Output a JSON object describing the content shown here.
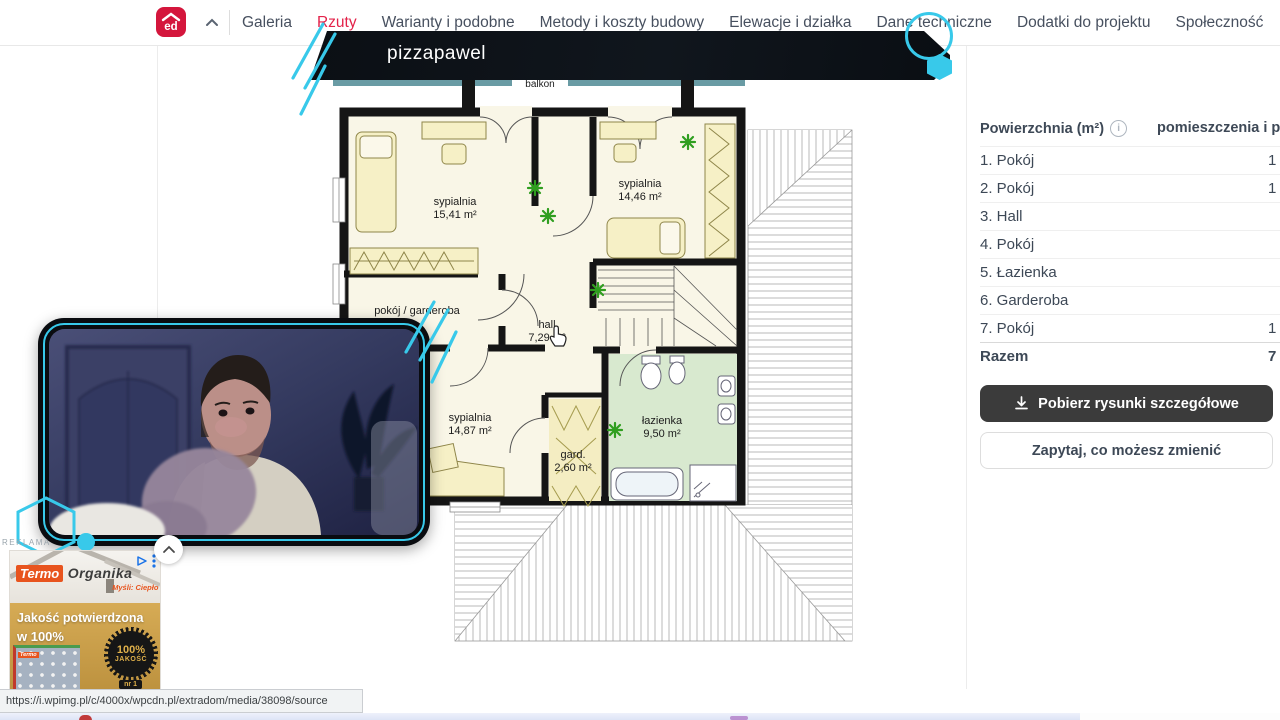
{
  "nav": {
    "logo_text": "ed",
    "tabs": [
      {
        "label": "Galeria"
      },
      {
        "label": "Rzuty"
      },
      {
        "label": "Warianty i podobne"
      },
      {
        "label": "Metody i koszty budowy"
      },
      {
        "label": "Elewacje i działka"
      },
      {
        "label": "Dane techniczne"
      },
      {
        "label": "Dodatki do projektu"
      },
      {
        "label": "Społeczność"
      }
    ]
  },
  "overlay": {
    "streamer_name": "pizzapawel"
  },
  "floorplan": {
    "balcony_label": "balkon",
    "rooms": [
      {
        "name": "sypialnia",
        "area": "15,41 m²"
      },
      {
        "name": "sypialnia",
        "area": "14,46 m²"
      },
      {
        "name": "pokój / garderoba",
        "area": ""
      },
      {
        "name": "hall",
        "area": "7,29 m²"
      },
      {
        "name": "sypialnia",
        "area": "14,87 m²"
      },
      {
        "name": "gard.",
        "area": "2,60 m²"
      },
      {
        "name": "łazienka",
        "area": "9,50 m²"
      }
    ]
  },
  "sidebar": {
    "header_left": "Powierzchnia (m²)",
    "info_icon_text": "i",
    "header_right": "pomieszczenia i pod",
    "rows": [
      {
        "label": "1. Pokój",
        "value": "1"
      },
      {
        "label": "2. Pokój",
        "value": "1"
      },
      {
        "label": "3. Hall",
        "value": ""
      },
      {
        "label": "4. Pokój",
        "value": ""
      },
      {
        "label": "5. Łazienka",
        "value": ""
      },
      {
        "label": "6. Garderoba",
        "value": ""
      },
      {
        "label": "7. Pokój",
        "value": "1"
      }
    ],
    "total_label": "Razem",
    "total_value": "7",
    "download_button": "Pobierz rysunki szczegółowe",
    "ask_button": "Zapytaj, co możesz zmienić"
  },
  "ad": {
    "section_label": "REKLAMA",
    "brand_part1": "Termo",
    "brand_part2": "Organika",
    "tagline": "Myśli: Ciepło",
    "headline_line1": "Jakość potwierdzona",
    "headline_line2": "w 100%",
    "badge_line1": "100%",
    "badge_line2": "JAKOŚĆ",
    "badge_line3": "nr 1",
    "pack_label": "Termo"
  },
  "statusbar": {
    "url": "https://i.wpimg.pl/c/4000x/wpcdn.pl/extradom/media/38098/source"
  },
  "colors": {
    "accent_cyan": "#38c9ea",
    "brand_red": "#d4163c",
    "active_tab_red": "#e32249",
    "bathroom_green": "#d8e9cf",
    "floor_cream": "#f9f6e7"
  }
}
